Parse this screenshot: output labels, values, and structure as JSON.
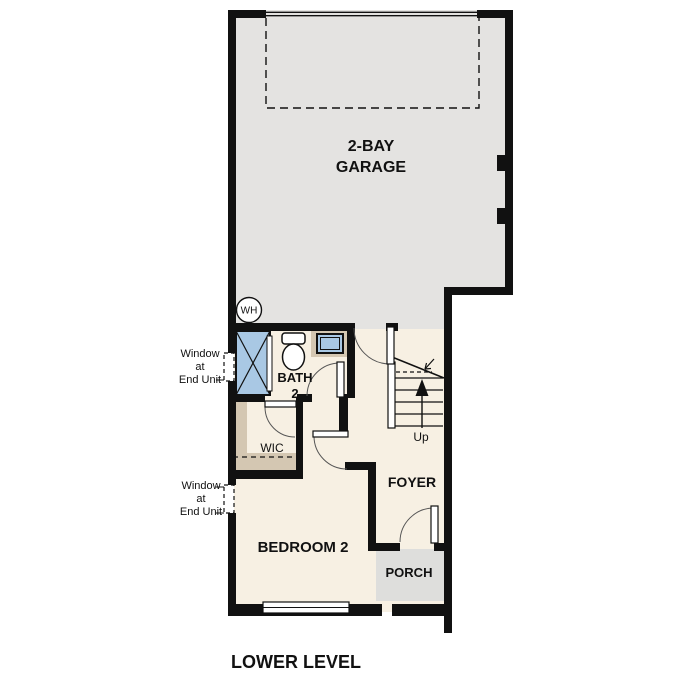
{
  "title": "LOWER LEVEL",
  "colors": {
    "wall": "#111111",
    "garage_floor": "#e4e3e1",
    "room_floor": "#f7f0e3",
    "closet": "#d4c7b2",
    "fixture_blue": "#a9c8e4",
    "porch_floor": "#dededc",
    "window_fill": "#ffffff"
  },
  "rooms": {
    "garage": {
      "line1": "2-BAY",
      "line2": "GARAGE"
    },
    "bath": {
      "line1": "BATH",
      "line2": "2"
    },
    "wic": {
      "label": "WIC"
    },
    "foyer": {
      "label": "FOYER"
    },
    "bedroom": {
      "label": "BEDROOM 2"
    },
    "porch": {
      "label": "PORCH"
    }
  },
  "annotations": {
    "water_heater": "WH",
    "stairs": "Up",
    "window_note_upper": {
      "line1": "Window",
      "line2": "at",
      "line3": "End Unit"
    },
    "window_note_lower": {
      "line1": "Window",
      "line2": "at",
      "line3": "End Unit"
    }
  }
}
